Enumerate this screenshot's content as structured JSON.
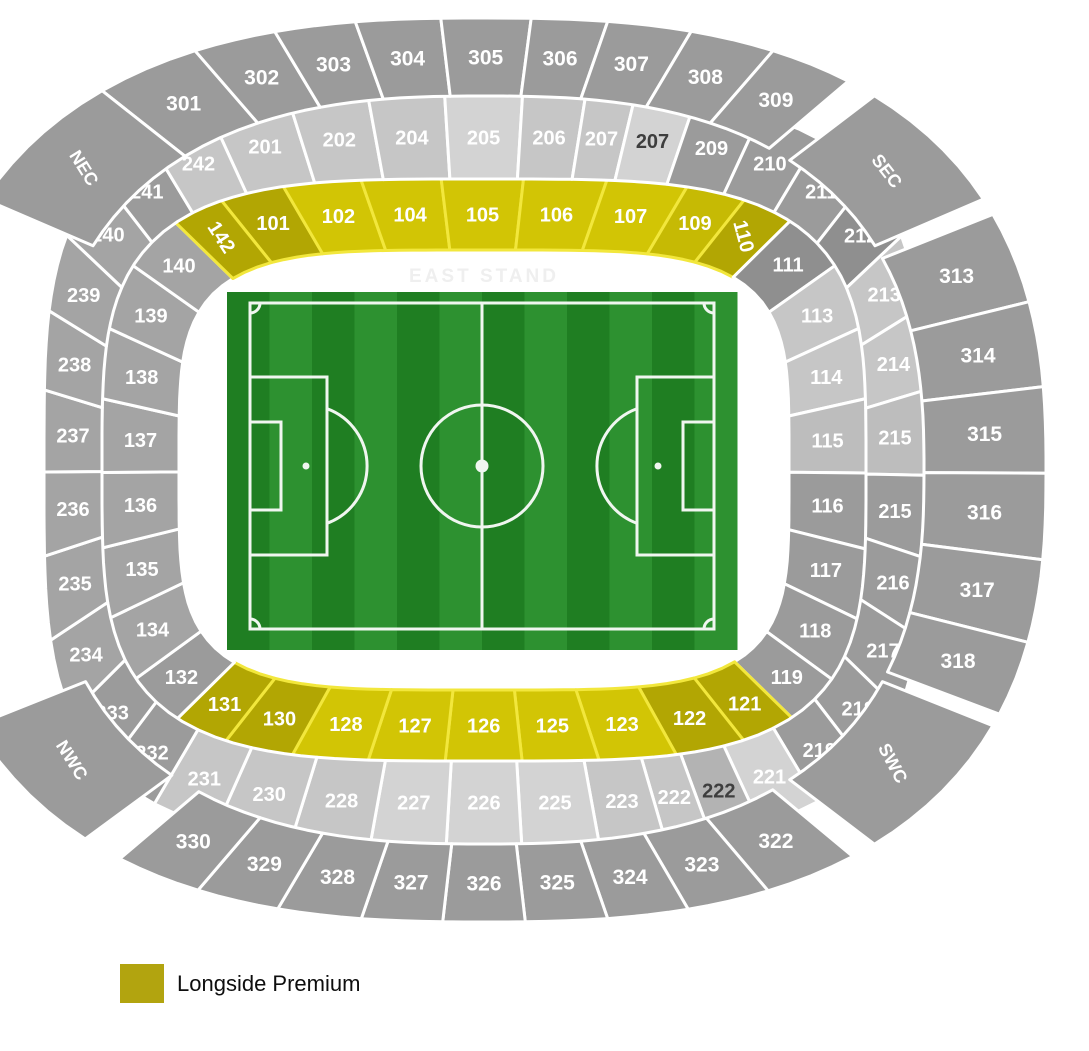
{
  "legend": {
    "label": "Longside Premium",
    "swatch_color": "#b2a40f"
  },
  "stand_labels": {
    "east": "EAST STAND"
  },
  "palette": {
    "g0": "#8f8f8f",
    "g1": "#9b9b9b",
    "g2": "#a4a4a4",
    "L1": "#c6c6c6",
    "L2": "#d3d3d3",
    "L3": "#bdbdbd",
    "L4": "#b3b3b3",
    "yB": "#d2c505",
    "yM": "#c6ba04",
    "yD": "#b2a603",
    "text_white": "#ffffff",
    "text_dark": "#3e3e3e",
    "stroke_gray": "#ffffff",
    "stroke_yellow": "#f2e73c"
  },
  "stadium": {
    "cx": 484,
    "cy": 470,
    "tiers": {
      "t1": {
        "n": 4.2,
        "aIn": 305,
        "aOut": 382,
        "bIn": 220,
        "bOut": 291,
        "fontSize": 20
      },
      "t2": {
        "n": 3.7,
        "aIn": 382,
        "aOut": 440,
        "bIn": 291,
        "bOut": 374,
        "fontSize": 20
      },
      "t3": {
        "n": 2.6,
        "aIn": 440,
        "aOut": 562,
        "bIn": 374,
        "bOut": 452,
        "fontSize": 21
      }
    },
    "sections": [
      {
        "id": "101",
        "label": "101",
        "tier": "t1",
        "t0": 233.5,
        "t1": 241.7,
        "fill": "yD"
      },
      {
        "id": "102",
        "label": "102",
        "tier": "t1",
        "t0": 241.7,
        "t1": 252.1,
        "fill": "yB"
      },
      {
        "id": "104",
        "label": "104",
        "tier": "t1",
        "t0": 252.1,
        "t1": 263.6,
        "fill": "yB"
      },
      {
        "id": "105",
        "label": "105",
        "tier": "t1",
        "t0": 263.6,
        "t1": 275.9,
        "fill": "yB"
      },
      {
        "id": "106",
        "label": "106",
        "tier": "t1",
        "t0": 275.9,
        "t1": 287.9,
        "fill": "yB"
      },
      {
        "id": "107",
        "label": "107",
        "tier": "t1",
        "t0": 287.9,
        "t1": 298.6,
        "fill": "yB"
      },
      {
        "id": "109",
        "label": "109",
        "tier": "t1",
        "t0": 298.6,
        "t1": 306.2,
        "fill": "yM"
      },
      {
        "id": "110",
        "label": "110",
        "tier": "t1",
        "t0": 306.2,
        "t1": 313.0,
        "fill": "yD",
        "rot": 75
      },
      {
        "id": "111",
        "label": "111",
        "tier": "t1",
        "t0": 313.0,
        "t1": 322.5,
        "fill": "g0"
      },
      {
        "id": "113",
        "label": "113",
        "tier": "t1",
        "t0": 322.5,
        "t1": 333.6,
        "fill": "L1"
      },
      {
        "id": "114",
        "label": "114",
        "tier": "t1",
        "t0": 333.6,
        "t1": 346.2,
        "fill": "L1"
      },
      {
        "id": "115",
        "label": "115",
        "tier": "t1",
        "t0": 346.2,
        "t1": 360.6,
        "fill": "L3"
      },
      {
        "id": "116",
        "label": "116",
        "tier": "t1",
        "t0": 0.6,
        "t1": 15.2,
        "fill": "g1"
      },
      {
        "id": "117",
        "label": "117",
        "tier": "t1",
        "t0": 15.2,
        "t1": 27.7,
        "fill": "g1"
      },
      {
        "id": "118",
        "label": "118",
        "tier": "t1",
        "t0": 27.7,
        "t1": 38.4,
        "fill": "g1"
      },
      {
        "id": "119",
        "label": "119",
        "tier": "t1",
        "t0": 38.4,
        "t1": 46.7,
        "fill": "g1"
      },
      {
        "id": "121",
        "label": "121",
        "tier": "t1",
        "t0": 46.7,
        "t1": 53.9,
        "fill": "yD"
      },
      {
        "id": "122",
        "label": "122",
        "tier": "t1",
        "t0": 53.9,
        "t1": 62.8,
        "fill": "yD"
      },
      {
        "id": "123",
        "label": "123",
        "tier": "t1",
        "t0": 62.8,
        "t1": 73.2,
        "fill": "yB"
      },
      {
        "id": "125",
        "label": "125",
        "tier": "t1",
        "t0": 73.2,
        "t1": 84.3,
        "fill": "yB"
      },
      {
        "id": "126",
        "label": "126",
        "tier": "t1",
        "t0": 84.3,
        "t1": 95.8,
        "fill": "yB"
      },
      {
        "id": "127",
        "label": "127",
        "tier": "t1",
        "t0": 95.8,
        "t1": 106.9,
        "fill": "yB"
      },
      {
        "id": "128",
        "label": "128",
        "tier": "t1",
        "t0": 106.9,
        "t1": 117.1,
        "fill": "yB"
      },
      {
        "id": "130",
        "label": "130",
        "tier": "t1",
        "t0": 117.1,
        "t1": 125.9,
        "fill": "yD"
      },
      {
        "id": "131",
        "label": "131",
        "tier": "t1",
        "t0": 125.9,
        "t1": 133.1,
        "fill": "yD"
      },
      {
        "id": "132",
        "label": "132",
        "tier": "t1",
        "t0": 133.1,
        "t1": 141.7,
        "fill": "g1"
      },
      {
        "id": "134",
        "label": "134",
        "tier": "t1",
        "t0": 141.7,
        "t1": 152.5,
        "fill": "g2"
      },
      {
        "id": "135",
        "label": "135",
        "tier": "t1",
        "t0": 152.5,
        "t1": 165.0,
        "fill": "g2"
      },
      {
        "id": "136",
        "label": "136",
        "tier": "t1",
        "t0": 165.0,
        "t1": 179.5,
        "fill": "g2"
      },
      {
        "id": "137",
        "label": "137",
        "tier": "t1",
        "t0": 179.5,
        "t1": 193.8,
        "fill": "g2"
      },
      {
        "id": "138",
        "label": "138",
        "tier": "t1",
        "t0": 193.8,
        "t1": 206.4,
        "fill": "g2"
      },
      {
        "id": "139",
        "label": "139",
        "tier": "t1",
        "t0": 206.4,
        "t1": 217.5,
        "fill": "g2"
      },
      {
        "id": "140",
        "label": "140",
        "tier": "t1",
        "t0": 217.5,
        "t1": 226.6,
        "fill": "g2"
      },
      {
        "id": "142",
        "label": "142",
        "tier": "t1",
        "t0": 226.6,
        "t1": 233.5,
        "fill": "yD",
        "rot": 57
      },
      {
        "id": "201",
        "label": "201",
        "tier": "t2",
        "t0": 236.8,
        "t1": 245.8,
        "fill": "L1"
      },
      {
        "id": "202",
        "label": "202",
        "tier": "t2",
        "t0": 245.8,
        "t1": 255.2,
        "fill": "L1"
      },
      {
        "id": "204",
        "label": "204",
        "tier": "t2",
        "t0": 255.2,
        "t1": 264.9,
        "fill": "L1"
      },
      {
        "id": "205",
        "label": "205",
        "tier": "t2",
        "t0": 264.9,
        "t1": 275.0,
        "fill": "L2"
      },
      {
        "id": "206",
        "label": "206",
        "tier": "t2",
        "t0": 275.0,
        "t1": 283.0,
        "fill": "L1"
      },
      {
        "id": "207",
        "label": "207",
        "tier": "t2",
        "t0": 283.0,
        "t1": 289.0,
        "fill": "L1"
      },
      {
        "id": "207b",
        "label": "207",
        "tier": "t2",
        "t0": 289.0,
        "t1": 296.0,
        "fill": "L2",
        "tk": "text_dark"
      },
      {
        "id": "209",
        "label": "209",
        "tier": "t2",
        "t0": 296.0,
        "t1": 303.5,
        "fill": "g1"
      },
      {
        "id": "210",
        "label": "210",
        "tier": "t2",
        "t0": 303.5,
        "t1": 310.6,
        "fill": "g1"
      },
      {
        "id": "211",
        "label": "211",
        "tier": "t2",
        "t0": 310.6,
        "t1": 318.2,
        "fill": "g1"
      },
      {
        "id": "212",
        "label": "212",
        "tier": "t2",
        "t0": 318.2,
        "t1": 326.6,
        "fill": "g0"
      },
      {
        "id": "213",
        "label": "213",
        "tier": "t2",
        "t0": 326.6,
        "t1": 336.5,
        "fill": "L1"
      },
      {
        "id": "214",
        "label": "214",
        "tier": "t2",
        "t0": 336.5,
        "t1": 348.0,
        "fill": "L1"
      },
      {
        "id": "215",
        "label": "215",
        "tier": "t2",
        "t0": 348.0,
        "t1": 360.8,
        "fill": "L3"
      },
      {
        "id": "215b",
        "label": "215",
        "tier": "t2",
        "t0": 0.8,
        "t1": 13.2,
        "fill": "g1"
      },
      {
        "id": "216",
        "label": "216",
        "tier": "t2",
        "t0": 13.2,
        "t1": 24.3,
        "fill": "g1"
      },
      {
        "id": "217",
        "label": "217",
        "tier": "t2",
        "t0": 24.3,
        "t1": 34.2,
        "fill": "g1"
      },
      {
        "id": "218",
        "label": "218",
        "tier": "t2",
        "t0": 34.2,
        "t1": 42.3,
        "fill": "g1"
      },
      {
        "id": "219",
        "label": "219",
        "tier": "t2",
        "t0": 42.3,
        "t1": 49.5,
        "fill": "g1"
      },
      {
        "id": "221",
        "label": "221",
        "tier": "t2",
        "t0": 49.5,
        "t1": 56.5,
        "fill": "L2"
      },
      {
        "id": "222b",
        "label": "222",
        "tier": "t2",
        "t0": 56.5,
        "t1": 62.2,
        "fill": "L4",
        "tk": "text_dark"
      },
      {
        "id": "222",
        "label": "222",
        "tier": "t2",
        "t0": 62.2,
        "t1": 67.4,
        "fill": "L1"
      },
      {
        "id": "223",
        "label": "223",
        "tier": "t2",
        "t0": 67.4,
        "t1": 75.3,
        "fill": "L1"
      },
      {
        "id": "225",
        "label": "225",
        "tier": "t2",
        "t0": 75.3,
        "t1": 85.1,
        "fill": "L2"
      },
      {
        "id": "226",
        "label": "226",
        "tier": "t2",
        "t0": 85.1,
        "t1": 94.9,
        "fill": "L2"
      },
      {
        "id": "227",
        "label": "227",
        "tier": "t2",
        "t0": 94.9,
        "t1": 104.5,
        "fill": "L2"
      },
      {
        "id": "228",
        "label": "228",
        "tier": "t2",
        "t0": 104.5,
        "t1": 113.9,
        "fill": "L1"
      },
      {
        "id": "230",
        "label": "230",
        "tier": "t2",
        "t0": 113.9,
        "t1": 122.5,
        "fill": "L1"
      },
      {
        "id": "231",
        "label": "231",
        "tier": "t2",
        "t0": 122.5,
        "t1": 130.0,
        "fill": "L1"
      },
      {
        "id": "232",
        "label": "232",
        "tier": "t2",
        "t0": 130.0,
        "t1": 137.1,
        "fill": "g1"
      },
      {
        "id": "233",
        "label": "233",
        "tier": "t2",
        "t0": 137.1,
        "t1": 145.2,
        "fill": "g1"
      },
      {
        "id": "234",
        "label": "234",
        "tier": "t2",
        "t0": 145.2,
        "t1": 155.2,
        "fill": "g2"
      },
      {
        "id": "235",
        "label": "235",
        "tier": "t2",
        "t0": 155.2,
        "t1": 167.0,
        "fill": "g2"
      },
      {
        "id": "236",
        "label": "236",
        "tier": "t2",
        "t0": 167.0,
        "t1": 179.7,
        "fill": "g2"
      },
      {
        "id": "237",
        "label": "237",
        "tier": "t2",
        "t0": 179.7,
        "t1": 192.1,
        "fill": "g2"
      },
      {
        "id": "238",
        "label": "238",
        "tier": "t2",
        "t0": 192.1,
        "t1": 203.3,
        "fill": "g2"
      },
      {
        "id": "239",
        "label": "239",
        "tier": "t2",
        "t0": 203.3,
        "t1": 213.5,
        "fill": "g2"
      },
      {
        "id": "240",
        "label": "240",
        "tier": "t2",
        "t0": 213.5,
        "t1": 222.0,
        "fill": "g2"
      },
      {
        "id": "241",
        "label": "241",
        "tier": "t2",
        "t0": 222.0,
        "t1": 229.2,
        "fill": "g1"
      },
      {
        "id": "242",
        "label": "242",
        "tier": "t2",
        "t0": 229.2,
        "t1": 236.8,
        "fill": "L1"
      },
      {
        "id": "301",
        "label": "301",
        "tier": "t3",
        "t0": 231.0,
        "t1": 241.0,
        "fill": "g1"
      },
      {
        "id": "302",
        "label": "302",
        "tier": "t3",
        "t0": 241.0,
        "t1": 249.0,
        "fill": "g1"
      },
      {
        "id": "303",
        "label": "303",
        "tier": "t3",
        "t0": 249.0,
        "t1": 257.0,
        "fill": "g1"
      },
      {
        "id": "304",
        "label": "304",
        "tier": "t3",
        "t0": 257.0,
        "t1": 265.6,
        "fill": "g1"
      },
      {
        "id": "305",
        "label": "305",
        "tier": "t3",
        "t0": 265.6,
        "t1": 274.8,
        "fill": "g1"
      },
      {
        "id": "306",
        "label": "306",
        "tier": "t3",
        "t0": 274.8,
        "t1": 282.5,
        "fill": "g1"
      },
      {
        "id": "307",
        "label": "307",
        "tier": "t3",
        "t0": 282.5,
        "t1": 290.8,
        "fill": "g1"
      },
      {
        "id": "308",
        "label": "308",
        "tier": "t3",
        "t0": 290.8,
        "t1": 299.0,
        "fill": "g1"
      },
      {
        "id": "309",
        "label": "309",
        "tier": "t3",
        "t0": 299.0,
        "t1": 307.0,
        "fill": "g1"
      },
      {
        "id": "SEC",
        "label": "SEC",
        "tier": "t3",
        "t0": 310.0,
        "t1": 326.0,
        "fill": "g1",
        "rot": 52,
        "fs": 18
      },
      {
        "id": "313",
        "label": "313",
        "tier": "t3",
        "t0": 328.0,
        "t1": 339.0,
        "fill": "g1"
      },
      {
        "id": "314",
        "label": "314",
        "tier": "t3",
        "t0": 339.0,
        "t1": 349.5,
        "fill": "g1"
      },
      {
        "id": "315",
        "label": "315",
        "tier": "t3",
        "t0": 349.5,
        "t1": 360.4,
        "fill": "g1"
      },
      {
        "id": "316",
        "label": "316",
        "tier": "t3",
        "t0": 0.4,
        "t1": 11.3,
        "fill": "g1"
      },
      {
        "id": "317",
        "label": "317",
        "tier": "t3",
        "t0": 11.3,
        "t1": 21.5,
        "fill": "g1"
      },
      {
        "id": "318",
        "label": "318",
        "tier": "t3",
        "t0": 21.5,
        "t1": 30.5,
        "fill": "g1"
      },
      {
        "id": "SWC",
        "label": "SWC",
        "tier": "t3",
        "t0": 32.0,
        "t1": 50.0,
        "fill": "g1",
        "rot": 62,
        "fs": 18
      },
      {
        "id": "322",
        "label": "322",
        "tier": "t3",
        "t0": 52.5,
        "t1": 61.5,
        "fill": "g1"
      },
      {
        "id": "323",
        "label": "323",
        "tier": "t3",
        "t0": 61.5,
        "t1": 69.5,
        "fill": "g1"
      },
      {
        "id": "324",
        "label": "324",
        "tier": "t3",
        "t0": 69.5,
        "t1": 77.5,
        "fill": "g1"
      },
      {
        "id": "325",
        "label": "325",
        "tier": "t3",
        "t0": 77.5,
        "t1": 85.8,
        "fill": "g1"
      },
      {
        "id": "326",
        "label": "326",
        "tier": "t3",
        "t0": 85.8,
        "t1": 94.2,
        "fill": "g1"
      },
      {
        "id": "327",
        "label": "327",
        "tier": "t3",
        "t0": 94.2,
        "t1": 102.4,
        "fill": "g1"
      },
      {
        "id": "328",
        "label": "328",
        "tier": "t3",
        "t0": 102.4,
        "t1": 110.7,
        "fill": "g1"
      },
      {
        "id": "329",
        "label": "329",
        "tier": "t3",
        "t0": 110.7,
        "t1": 118.7,
        "fill": "g1"
      },
      {
        "id": "330",
        "label": "330",
        "tier": "t3",
        "t0": 118.7,
        "t1": 127.0,
        "fill": "g1"
      },
      {
        "id": "NWC",
        "label": "NWC",
        "tier": "t3",
        "t0": 131.0,
        "t1": 148.0,
        "fill": "g1",
        "rot": 58,
        "fs": 18
      },
      {
        "id": "NEC",
        "label": "NEC",
        "tier": "t3",
        "t0": 214.0,
        "t1": 231.0,
        "fill": "g1",
        "rot": 58,
        "fs": 18
      }
    ]
  },
  "pitch": {
    "x": 227,
    "y": 292,
    "width": 510,
    "height": 358,
    "stripe_count": 12,
    "grass_dark": "#1f7e22",
    "grass_light": "#2d9130",
    "line_color": "#f0f6f0"
  }
}
